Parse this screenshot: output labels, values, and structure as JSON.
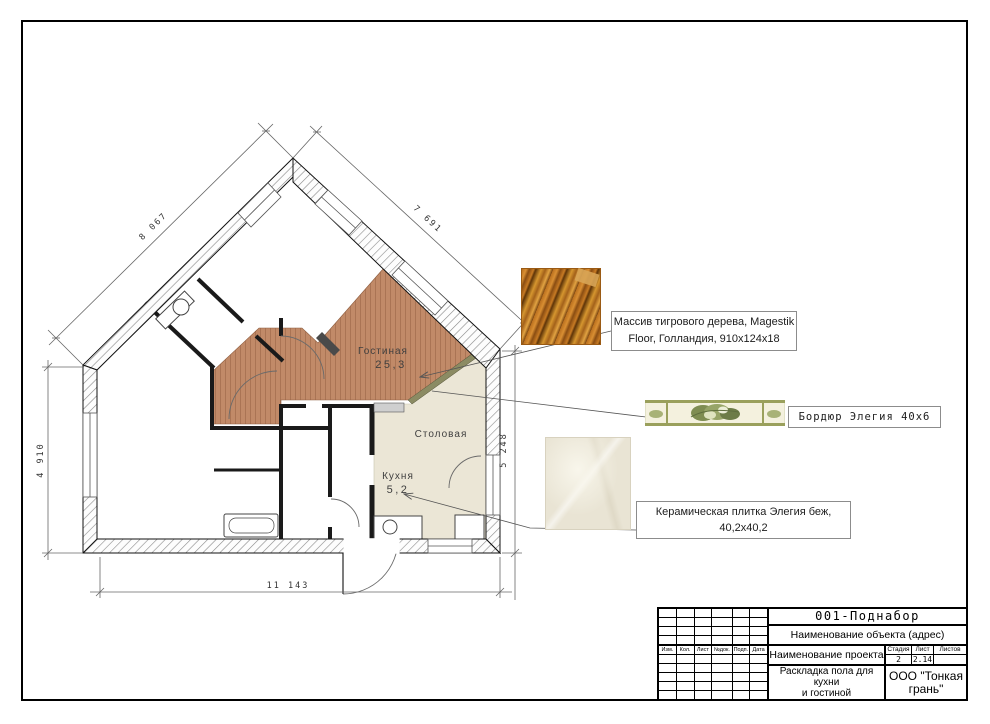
{
  "page": {
    "background": "#ffffff",
    "frame_color": "#000000"
  },
  "plan": {
    "rooms": {
      "living": {
        "label": "Гостиная",
        "area": "25,3",
        "floor_color": "#c18a68"
      },
      "dining": {
        "label": "Столовая",
        "floor_color": "#ebe6d6"
      },
      "kitchen": {
        "label": "Кухня",
        "area": "5,2",
        "floor_color": "#ebe6d6"
      }
    },
    "dimensions": {
      "upper_left": "8 067",
      "upper_right": "7 691",
      "left": "4 910",
      "right": "5 248",
      "bottom": "11 143"
    },
    "colors": {
      "border_strip": "#8b8b63",
      "wall_outline": "#1a1a1a"
    }
  },
  "callouts": {
    "wood": {
      "line1": "Массив тигрового дерева, Magestik",
      "line2": "Floor, Голландия, 910х124х18"
    },
    "border": {
      "line1": "Бордюр Элегия 40х6"
    },
    "ceramic": {
      "line1": "Керамическая плитка Элегия беж,",
      "line2": "40,2х40,2"
    }
  },
  "swatches": {
    "wood": "tiger-wood-photo",
    "border": "elegia-border-tile-photo",
    "ceramic": "elegia-beige-tile-photo"
  },
  "title_block": {
    "doc_code": "001-Поднабор",
    "object_name": "Наименование объекта (адрес)",
    "project_name": "Наименование проекта",
    "sheet_title_line1": "Раскладка пола для кухни",
    "sheet_title_line2": "и гостиной",
    "company_line1": "ООО \"Тонкая",
    "company_line2": "грань\"",
    "stage_header": "Стадия",
    "sheet_header": "Лист",
    "sheets_header": "Листов",
    "stage_value": "2",
    "sheet_value": "2.14",
    "sheets_value": "",
    "revision_headers": [
      "Изм.",
      "Кол.",
      "Лист",
      "№док.",
      "Подп.",
      "Дата"
    ]
  }
}
